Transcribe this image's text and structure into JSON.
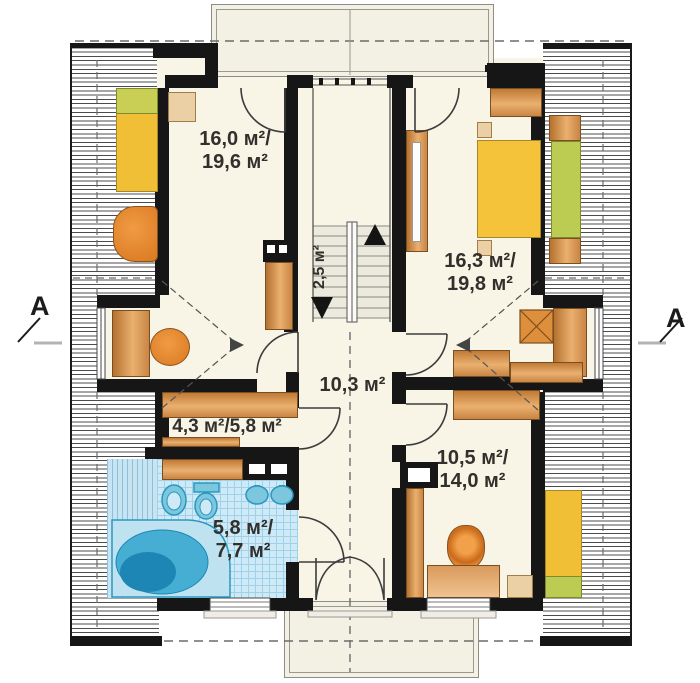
{
  "meta": {
    "type": "architectural floor plan",
    "floor": "attic storey"
  },
  "labels": {
    "bedroom_left_1": "16,0 м²/",
    "bedroom_left_2": "19,6 м²",
    "bedroom_right_1": "16,3 м²/",
    "bedroom_right_2": "19,8 м²",
    "hall": "10,3 м²",
    "closet": "4,3 м²/5,8 м²",
    "bathroom_1": "5,8 м²/",
    "bathroom_2": "7,7 м²",
    "room_bottom_right_1": "10,5 м²/",
    "room_bottom_right_2": "14,0 м²",
    "stairs": "2,5 м²",
    "section_left": "A",
    "section_right": "A"
  },
  "colors": {
    "wall": "#161616",
    "floor_cream": "#f8f4e6",
    "balcony_fill": "#f3f0e4",
    "hatch_line": "#2d2d2d",
    "furniture_orange_dark": "#b5712f",
    "furniture_orange_light": "#eab06f",
    "chair_orange": "#e0812f",
    "bed_yellow": "#f0bf35",
    "pillow_green": "#c9cf55",
    "bench_green": "#bccb51",
    "nightstand_tan": "#ead0a4",
    "tile_blue": "#cfeaf6",
    "fixture_blue": "#7cc6de",
    "fixture_stroke": "#2b97c0",
    "tub_mid": "#45aed2",
    "tub_dark": "#1d86b4",
    "dash_gray": "#6b6b6b"
  }
}
